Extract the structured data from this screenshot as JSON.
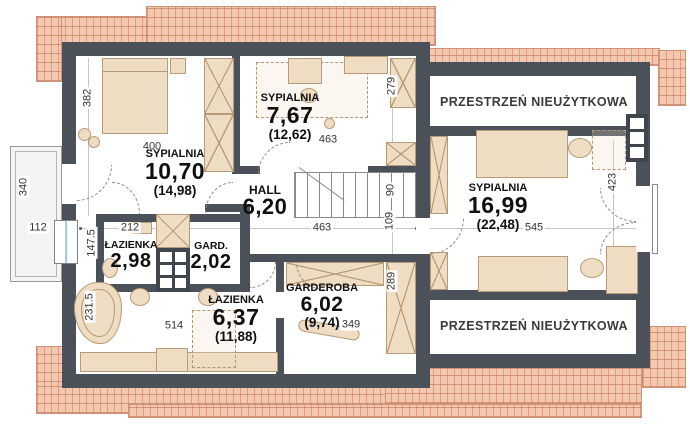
{
  "plan": {
    "rooms": [
      {
        "name": "SYPIALNIA",
        "area": "10,70",
        "gross": "(14,98)"
      },
      {
        "name": "SYPIALNIA",
        "area": "7,67",
        "gross": "(12,62)"
      },
      {
        "name": "HALL",
        "area": "6,20",
        "gross": ""
      },
      {
        "name": "ŁAZIENKA",
        "area": "2,98",
        "gross": ""
      },
      {
        "name": "GARD.",
        "area": "2,02",
        "gross": ""
      },
      {
        "name": "ŁAZIENKA",
        "area": "6,37",
        "gross": "(11,88)"
      },
      {
        "name": "GARDEROBA",
        "area": "6,02",
        "gross": "(9,74)"
      },
      {
        "name": "SYPIALNIA",
        "area": "16,99",
        "gross": "(22,48)"
      }
    ],
    "attic": {
      "top": "PRZESTRZEŃ NIEUŻYTKOWA",
      "bottom": "PRZESTRZEŃ NIEUŻYTKOWA"
    },
    "dims": {
      "w382": "382",
      "w400": "400",
      "w340": "340",
      "w112": "112",
      "w147_5": "147.5",
      "w212": "212",
      "w231_5": "231.5",
      "w514": "514",
      "w463a": "463",
      "w279": "279",
      "w463b": "463",
      "w90": "90",
      "w109": "109",
      "w289": "289",
      "w349": "349",
      "w423": "423",
      "w545": "545"
    },
    "colors": {
      "wall": "#4a5158",
      "roof": "#f3c8ae",
      "roof_line": "#cf9275",
      "furniture": "#eedcc3",
      "furniture_line": "#b99a77",
      "dim_text": "#333333"
    }
  }
}
